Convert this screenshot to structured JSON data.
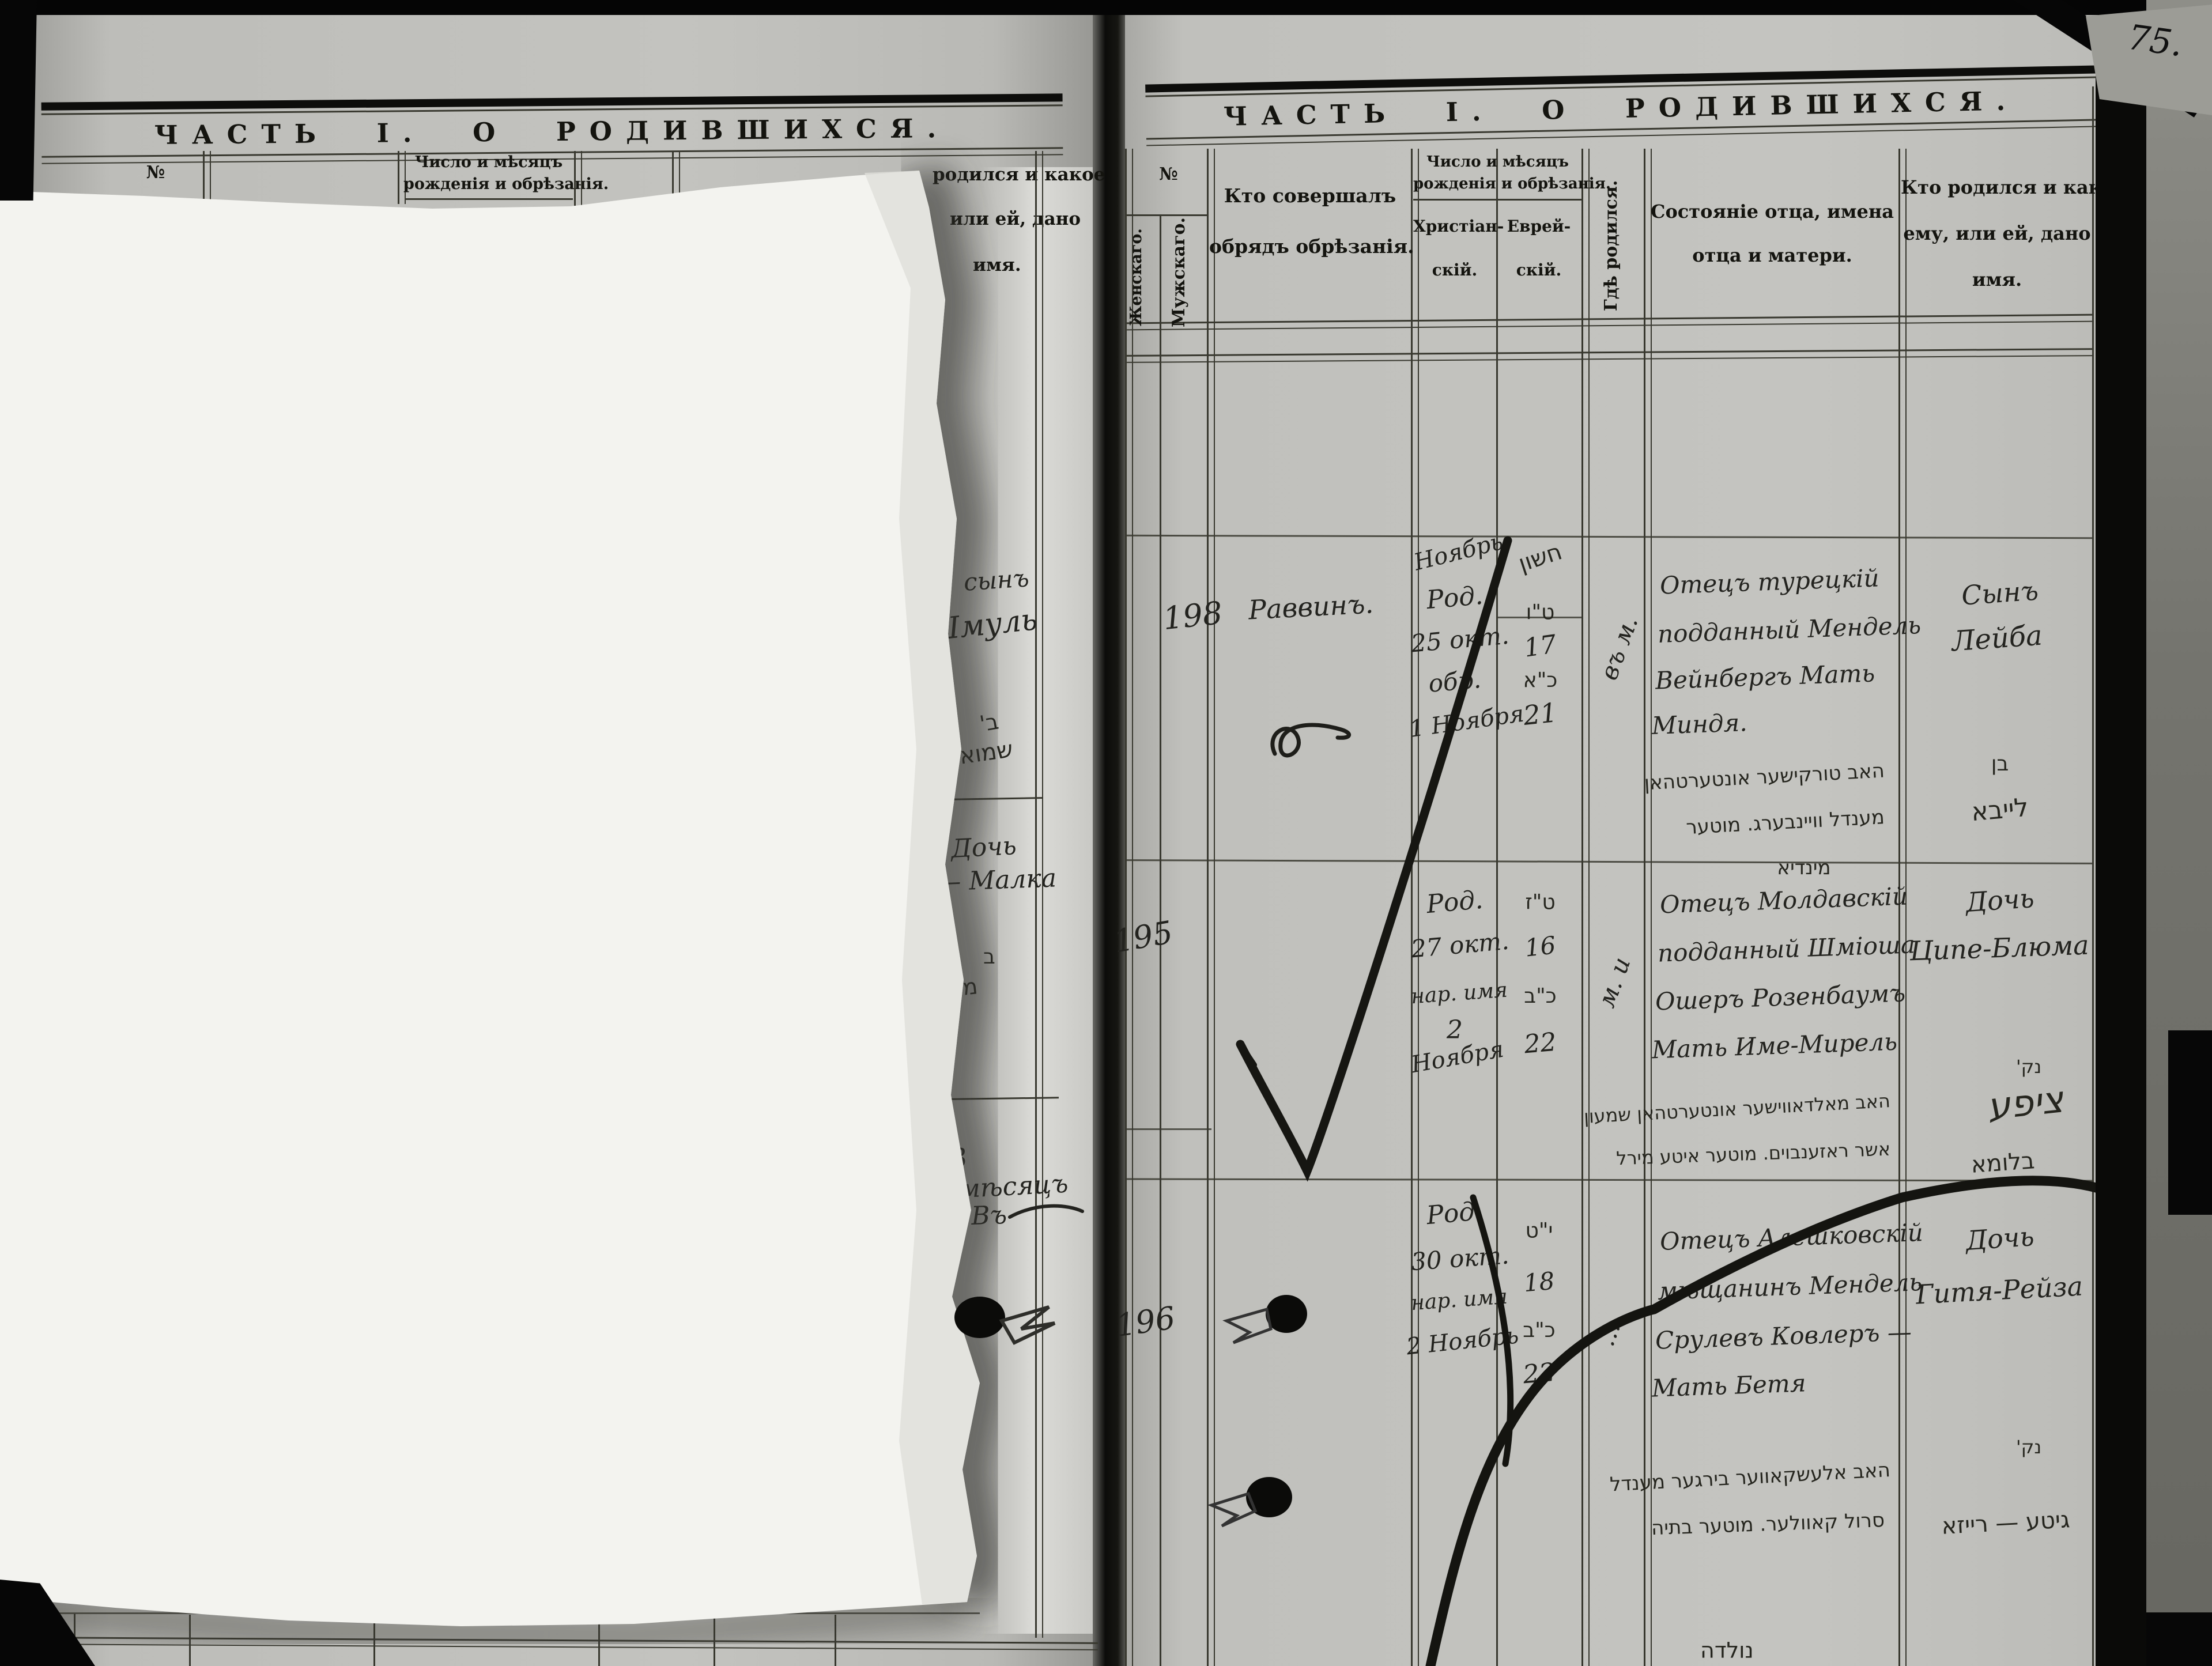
{
  "page_number": "75.",
  "colors": {
    "paper": "#c2c2be",
    "ink": "#1c1c1a",
    "sheet": "#f3f3ef"
  },
  "left_page": {
    "part_title": "ЧАСТЬ І. О РОДИВШИХСЯ.",
    "headers": {
      "no": "№",
      "date_group_line1": "Число и мѣсяцъ",
      "date_group_line2": "рожденія и обрѣзанія.",
      "name_line1": "родился и какое",
      "name_line2": "или ей, дано",
      "name_line3": "имя."
    },
    "entries": {
      "entry1_line1": "сынъ",
      "entry1_line2": "Шмуль",
      "entry1_heb1": "ב'",
      "entry1_heb2": "שמואל",
      "entry2_line1": "Дочь",
      "entry2_line2": "ія — Малка",
      "entry2_heb1": "ב",
      "entry2_heb2": "מלכה",
      "entry3_num": "23",
      "entry3_line1": "бръ мѣсяцъ",
      "entry3_line2": "оми. Въ"
    }
  },
  "right_page": {
    "part_title": "ЧАСТЬ І. О РОДИВШИХСЯ.",
    "headers": {
      "no": "№",
      "female": "Женскаго.",
      "male": "Мужскаго.",
      "performer_line1": "Кто совершалъ",
      "performer_line2": "обрядъ обрѣзанія.",
      "date_group_line1": "Число и мѣсяцъ",
      "date_group_line2": "рожденія и обрѣзанія.",
      "christian_line1": "Христіан-",
      "christian_line2": "скій.",
      "jewish_line1": "Еврей-",
      "jewish_line2": "скій.",
      "where_born": "Гдѣ родился.",
      "father_line1": "Состояніе отца, имена",
      "father_line2": "отца и матери.",
      "name_line1": "Кто родился и какое",
      "name_line2": "ему, или ей, дано",
      "name_line3": "имя."
    },
    "records": [
      {
        "number": "198",
        "performer": "Раввинъ.",
        "christian_date": [
          "Ноябрь",
          "Род.",
          "25 окт.",
          "обр.",
          "1 Ноября"
        ],
        "jewish_date": [
          "חשון",
          "ט\"ו",
          "17",
          "כ\"א",
          "21"
        ],
        "where_born": "въ м.",
        "father": [
          "Отецъ турецкій",
          "подданный Мендель",
          "Вейнбергъ Мать",
          "Миндя."
        ],
        "father_hebrew": [
          "האב טורקישער אונטערטהאן",
          "מענדל וויינבערג. מוטער",
          "מינדיא"
        ],
        "name": [
          "Сынъ",
          "Лейба"
        ],
        "name_hebrew": [
          "בן",
          "לייבא"
        ]
      },
      {
        "number": "195",
        "performer": "",
        "christian_date": [
          "Род.",
          "27 окт.",
          "нар. имя",
          "2",
          "Ноября"
        ],
        "jewish_date": [
          "ט\"ז",
          "16",
          "כ\"ב",
          "22"
        ],
        "where_born": "м. и",
        "father": [
          "Отецъ Молдавскій",
          "подданный Шміоша",
          "Ошеръ Розенбаумъ",
          "Мать Име-Мирель"
        ],
        "father_hebrew": [
          "האב מאלדאווישער אונטערטהאן שמעון",
          "אשר ראזענבוים. מוטער איטע מירל"
        ],
        "name": [
          "Дочь",
          "Ципе-Блюма"
        ],
        "name_hebrew": [
          "נק'",
          "ציפע",
          "בלומא"
        ]
      },
      {
        "number": "196",
        "performer": "",
        "christian_date": [
          "Род.",
          "30 окт.",
          "нар. имя",
          "2 Ноябрь"
        ],
        "jewish_date": [
          "י\"ט",
          "18",
          "כ\"ב",
          "22"
        ],
        "where_born": "…",
        "father": [
          "Отецъ Алешковскій",
          "мѣщанинъ Мендель",
          "Срулевъ Ковлеръ —",
          "Мать Бетя"
        ],
        "father_hebrew": [
          "האב אלעשקאווער בירגער מענדל",
          "סרול קאוולער. מוטער בתיה",
          "נולדה"
        ],
        "name": [
          "Дочь",
          "Гитя-Рейза"
        ],
        "name_hebrew": [
          "נק'",
          "גיטע — רייזא"
        ]
      }
    ]
  }
}
